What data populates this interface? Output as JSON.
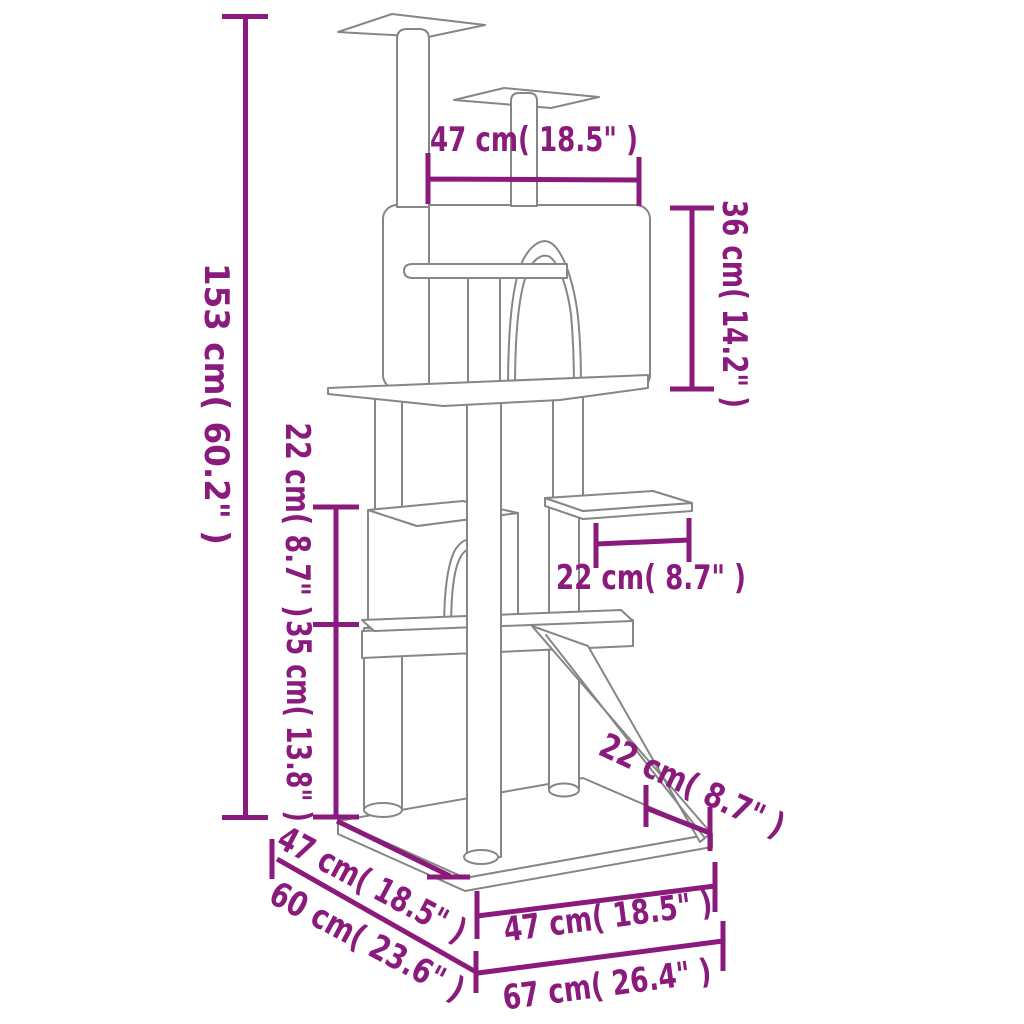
{
  "title": "Cat tree dimension diagram",
  "colors": {
    "dimension": "#8a1a7b",
    "drawing_line": "#868686",
    "background": "#ffffff"
  },
  "dims": {
    "total_height": "153 cm( 60.2\" )",
    "top_width": "47 cm( 18.5\" )",
    "house_height": "36 cm( 14.2\" )",
    "upper_gap_height": "22 cm( 8.7\" )",
    "lower_section_height": "35 cm( 13.8\" )",
    "perch_width": "22 cm( 8.7\" )",
    "ramp_width": "22 cm( 8.7\" )",
    "base_depth": "47 cm( 18.5\" )",
    "total_depth": "60 cm( 23.6\" )",
    "base_width": "47 cm( 18.5\" )",
    "total_width": "67 cm( 26.4\" )"
  }
}
